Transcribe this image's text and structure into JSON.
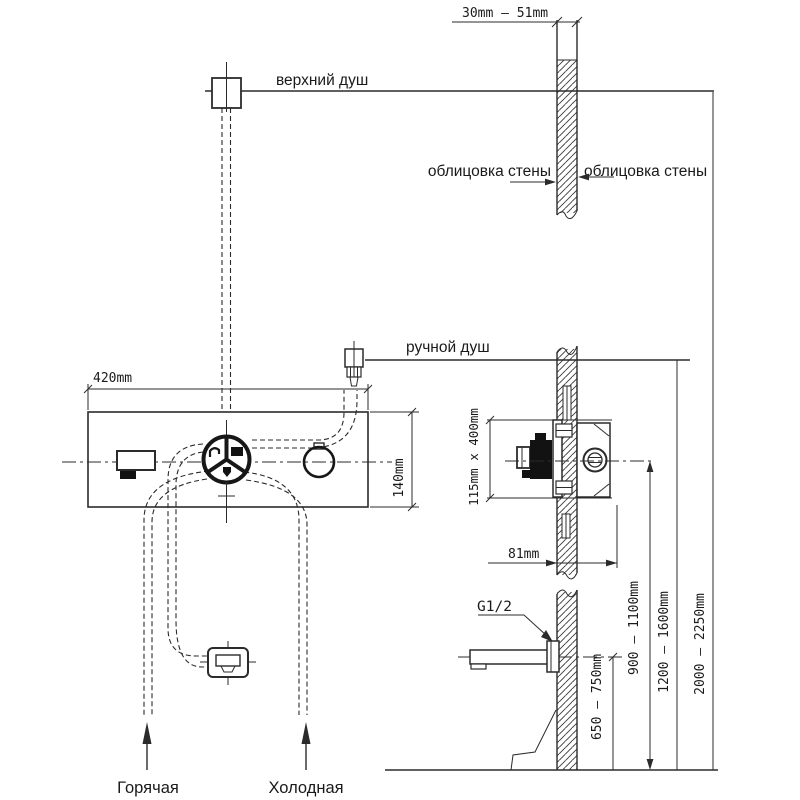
{
  "title": "Схема установки встраиваемого смесителя для душа",
  "colors": {
    "line": "#2b2b2b",
    "text": "#1a1a1a",
    "background": "#ffffff"
  },
  "labels": {
    "wall_thickness": "30mm  —  51mm",
    "overhead_shower": "верхний душ",
    "cladding_left": "облицовка стены",
    "cladding_right": "облицовка стены",
    "hand_shower": "ручной душ",
    "panel_width": "420mm",
    "panel_height": "140mm",
    "recess_size": "115mm x 400mm",
    "recess_depth": "81mm",
    "thread_size": "G1/2",
    "spout_height": "650 — 750mm",
    "mixer_height": "900 — 1100mm",
    "hand_shower_height": "1200 — 1600mm",
    "overhead_height": "2000 — 2250mm",
    "hot_supply": "Горячая",
    "cold_supply": "Холодная"
  }
}
